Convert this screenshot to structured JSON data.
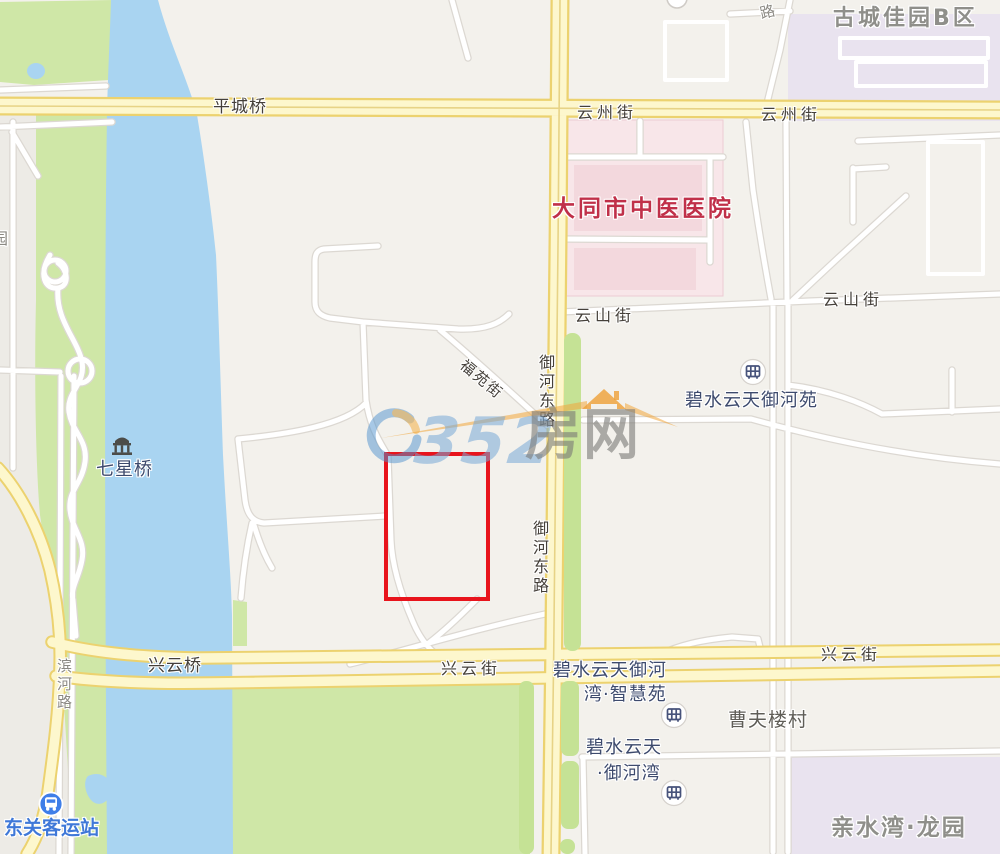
{
  "map_type": "web-map-screenshot",
  "city_area": "大同",
  "roads": {
    "pingchengqiao": "平城桥",
    "yunzhoujie": "云州街",
    "yunshanjie": "云山街",
    "xingyunjie": "兴云街",
    "xingyunqiao": "兴云桥",
    "yuhedonglu": "御河东路",
    "fuyuanjie": "福苑街",
    "binhelu": "滨河路",
    "lu_partial": "路"
  },
  "pois": {
    "yuan_partial": "园",
    "hospital": "大同市中医医院",
    "gucheng_jiayuan": "古城佳园B区",
    "bishui_yuheyuan": "碧水云天御河苑",
    "zhihuiyuan_line1": "碧水云天御河",
    "zhihuiyuan_line2": "湾·智慧苑",
    "yuhewan_line1": "碧水云天",
    "yuhewan_line2": "·御河湾",
    "caofulou_village": "曹夫楼村",
    "qinshuiwan": "亲水湾·龙园",
    "qixingqiao": "七星桥",
    "bus_station": "东关客运站"
  },
  "watermark": {
    "text": "0352房网",
    "digits": "352",
    "suffix": "房网"
  },
  "icons": {
    "bus_station_icon": "bus-in-blue-circle",
    "residential_icon": "building-in-white-circle",
    "landmark_icon": "bridge-pavilion"
  },
  "colors": {
    "background": "#f3f1ec",
    "river_blue": "#a9d4f1",
    "park_green": "#cfe7a7",
    "road_yellow_fill": "#fcf5c9",
    "road_yellow_edge": "#ecd26f",
    "hospital_pink": "#f8e6e9",
    "residential_lavender": "#e9e3ef",
    "highlight_red": "#e8141c",
    "hospital_text": "#c03049",
    "poi_text_navy": "#3d4a6d",
    "transit_blue": "#3f7ee8",
    "district_text_gray": "#8f8f8a",
    "watermark_blue": "#76a8d7",
    "watermark_orange": "#f0a43c"
  }
}
